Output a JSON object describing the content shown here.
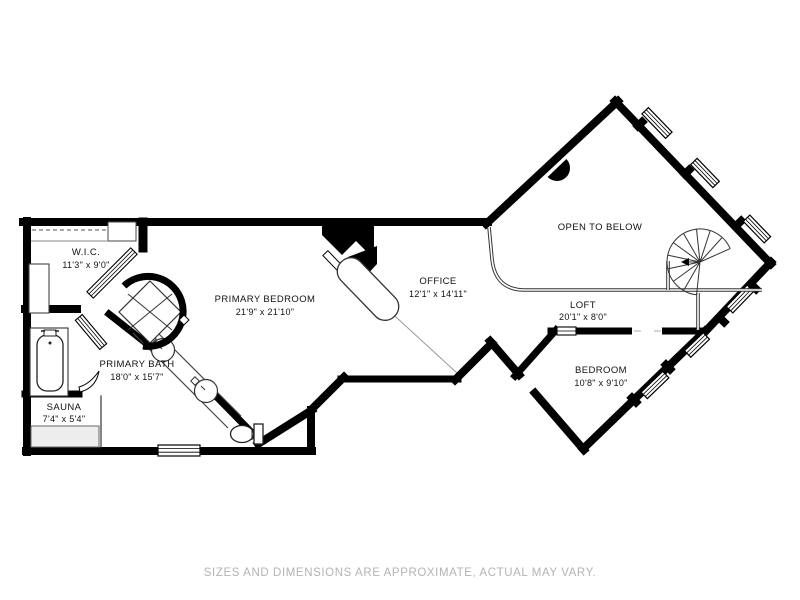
{
  "plan": {
    "type": "floor-plan",
    "rooms": {
      "wic": {
        "name": "W.I.C.",
        "dims": "11'3\" x 9'0\""
      },
      "primary_bedroom": {
        "name": "PRIMARY BEDROOM",
        "dims": "21'9\" x 21'10\""
      },
      "primary_bath": {
        "name": "PRIMARY BATH",
        "dims": "18'0\" x 15'7\""
      },
      "sauna": {
        "name": "SAUNA",
        "dims": "7'4\" x 5'4\""
      },
      "office": {
        "name": "OFFICE",
        "dims": "12'1\" x 14'11\""
      },
      "open_to_below": {
        "name": "OPEN TO BELOW",
        "dims": ""
      },
      "loft": {
        "name": "LOFT",
        "dims": "20'1\" x 8'0\""
      },
      "bedroom": {
        "name": "BEDROOM",
        "dims": "10'8\" x 9'10\""
      }
    },
    "fixtures": [
      "spiral-staircase",
      "fireplace",
      "bathtub",
      "shower",
      "double-vanity-sinks",
      "toilet",
      "sauna-bench",
      "desk",
      "closet-rod",
      "wardrobe",
      "doors",
      "windows"
    ],
    "colors": {
      "wall": "#000000",
      "label_text": "#111111",
      "disclaimer_text": "#b3b3b3",
      "background": "#ffffff",
      "bench_fill": "#ededed"
    }
  },
  "footer": {
    "disclaimer": "SIZES AND DIMENSIONS ARE APPROXIMATE, ACTUAL MAY VARY."
  }
}
